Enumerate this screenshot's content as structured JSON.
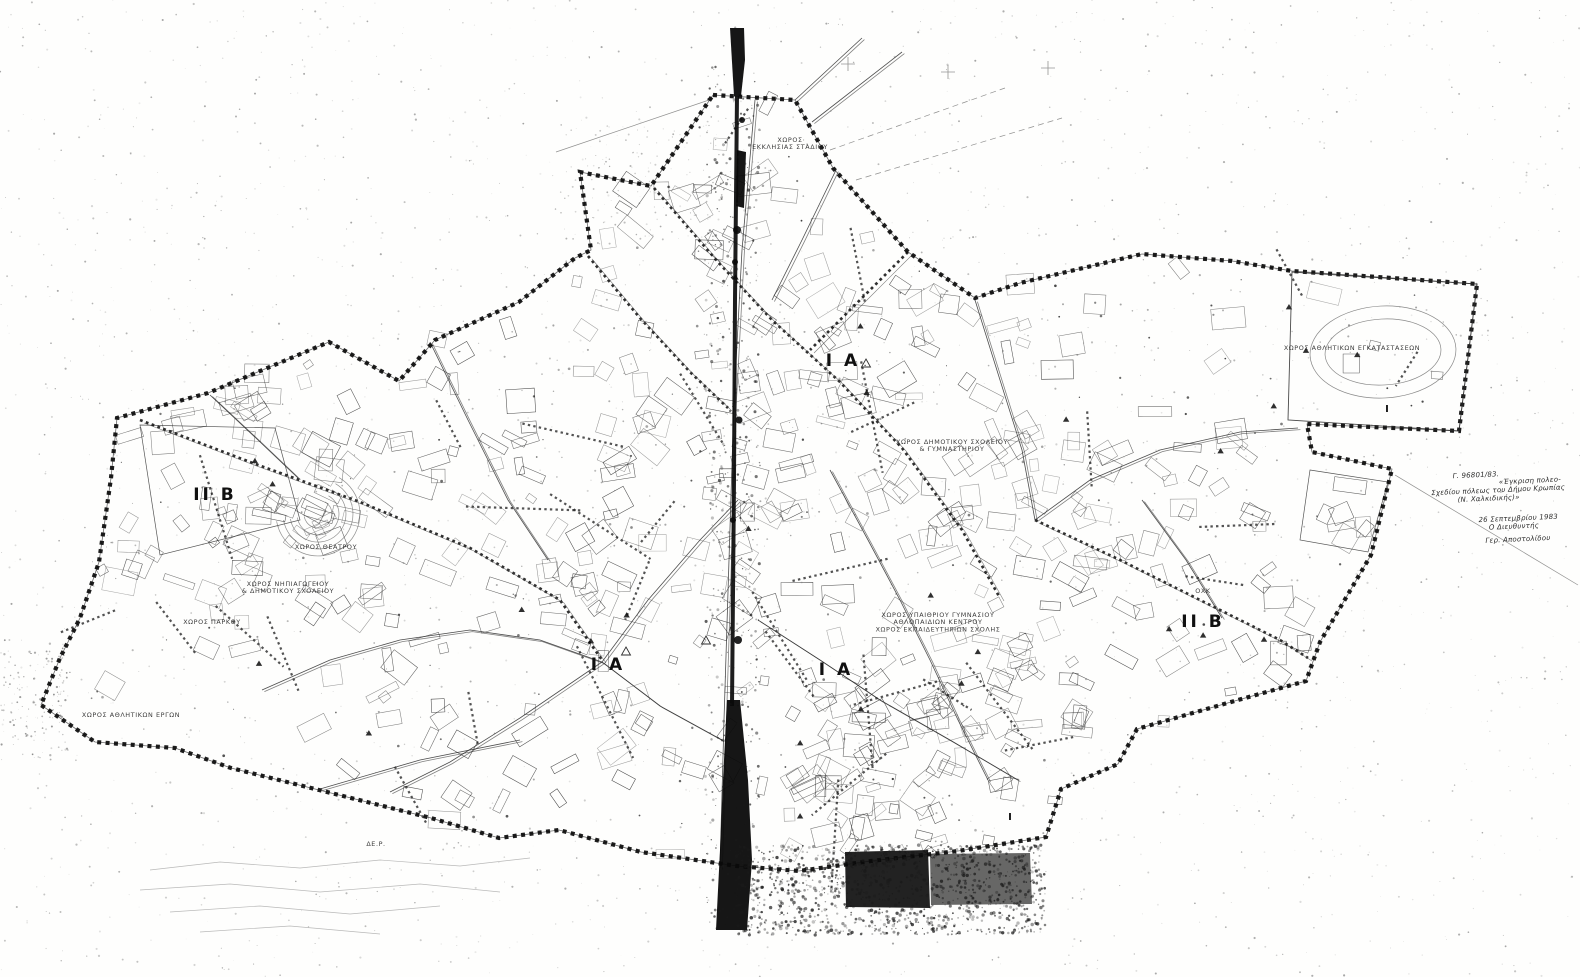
{
  "document": {
    "kind": "scanned black-and-white town plan (two sheets joined, dark fold seam in middle)",
    "ink_color": "#0a0a0a",
    "paper_color": "#fefefd"
  },
  "annotation": {
    "lines": [
      "Γ. 96801/83.",
      "«Έγκριση πολεο-",
      "Σχεδίου πόλεως του Δήμου Κρωπίας",
      "(Ν. Χαλκιδικής)»",
      "26 Σεπτεμβρίου 1983",
      "Ο Διευθυντής",
      "Γερ. Αποστολίδου"
    ]
  },
  "map": {
    "boundary": [
      [
        713,
        95
      ],
      [
        795,
        100
      ],
      [
        833,
        168
      ],
      [
        908,
        252
      ],
      [
        975,
        298
      ],
      [
        1020,
        283
      ],
      [
        1142,
        254
      ],
      [
        1232,
        261
      ],
      [
        1292,
        271
      ],
      [
        1477,
        284
      ],
      [
        1459,
        431
      ],
      [
        1307,
        424
      ],
      [
        1312,
        452
      ],
      [
        1392,
        469
      ],
      [
        1371,
        555
      ],
      [
        1320,
        642
      ],
      [
        1306,
        681
      ],
      [
        1238,
        700
      ],
      [
        1137,
        729
      ],
      [
        1118,
        764
      ],
      [
        1061,
        789
      ],
      [
        1046,
        837
      ],
      [
        958,
        851
      ],
      [
        871,
        861
      ],
      [
        799,
        871
      ],
      [
        737,
        866
      ],
      [
        641,
        852
      ],
      [
        559,
        830
      ],
      [
        499,
        838
      ],
      [
        431,
        818
      ],
      [
        319,
        790
      ],
      [
        231,
        768
      ],
      [
        175,
        748
      ],
      [
        95,
        742
      ],
      [
        41,
        705
      ],
      [
        60,
        658
      ],
      [
        80,
        618
      ],
      [
        99,
        562
      ],
      [
        111,
        478
      ],
      [
        117,
        418
      ],
      [
        208,
        393
      ],
      [
        329,
        342
      ],
      [
        399,
        381
      ],
      [
        435,
        340
      ],
      [
        519,
        302
      ],
      [
        575,
        258
      ],
      [
        591,
        250
      ],
      [
        580,
        172
      ],
      [
        651,
        186
      ]
    ],
    "roads": [
      {
        "style": "thin",
        "pts": [
          [
            755,
            100
          ],
          [
            742,
            250
          ],
          [
            734,
            400
          ],
          [
            729,
            560
          ],
          [
            724,
            720
          ],
          [
            720,
            868
          ]
        ]
      },
      {
        "style": "dotted",
        "pts": [
          [
            654,
            188
          ],
          [
            718,
            262
          ],
          [
            772,
            320
          ],
          [
            840,
            382
          ],
          [
            902,
            448
          ],
          [
            962,
            530
          ],
          [
            1000,
            598
          ]
        ]
      },
      {
        "style": "dotted",
        "pts": [
          [
            588,
            256
          ],
          [
            640,
            318
          ],
          [
            690,
            372
          ],
          [
            728,
            408
          ]
        ]
      },
      {
        "style": "dotted",
        "pts": [
          [
            140,
            420
          ],
          [
            250,
            462
          ],
          [
            360,
            502
          ],
          [
            470,
            548
          ],
          [
            560,
            600
          ],
          [
            602,
            660
          ]
        ]
      },
      {
        "style": "thin",
        "pts": [
          [
            602,
            662
          ],
          [
            520,
            718
          ],
          [
            450,
            762
          ],
          [
            390,
            792
          ]
        ]
      },
      {
        "style": "thin",
        "pts": [
          [
            602,
            662
          ],
          [
            660,
            706
          ],
          [
            722,
            740
          ]
        ]
      },
      {
        "style": "thin",
        "pts": [
          [
            602,
            662
          ],
          [
            648,
            600
          ],
          [
            700,
            540
          ],
          [
            738,
            500
          ]
        ]
      },
      {
        "style": "thin",
        "pts": [
          [
            602,
            662
          ],
          [
            540,
            640
          ],
          [
            470,
            630
          ],
          [
            400,
            640
          ],
          [
            330,
            660
          ],
          [
            262,
            690
          ]
        ]
      },
      {
        "style": "thin",
        "pts": [
          [
            975,
            300
          ],
          [
            1000,
            380
          ],
          [
            1022,
            450
          ],
          [
            1035,
            520
          ]
        ]
      },
      {
        "style": "dotted",
        "pts": [
          [
            1035,
            520
          ],
          [
            1120,
            560
          ],
          [
            1200,
            600
          ],
          [
            1280,
            640
          ],
          [
            1308,
            658
          ]
        ]
      },
      {
        "style": "thin",
        "pts": [
          [
            1035,
            520
          ],
          [
            1090,
            480
          ],
          [
            1160,
            450
          ],
          [
            1240,
            432
          ],
          [
            1298,
            428
          ]
        ]
      },
      {
        "style": "thin",
        "pts": [
          [
            830,
            470
          ],
          [
            868,
            540
          ],
          [
            900,
            600
          ],
          [
            930,
            660
          ],
          [
            958,
            720
          ],
          [
            988,
            780
          ]
        ]
      },
      {
        "style": "thin",
        "pts": [
          [
            758,
            620
          ],
          [
            820,
            660
          ],
          [
            880,
            700
          ],
          [
            950,
            740
          ],
          [
            1018,
            780
          ]
        ]
      },
      {
        "style": "thin",
        "pts": [
          [
            430,
            342
          ],
          [
            468,
            420
          ],
          [
            508,
            500
          ],
          [
            548,
            560
          ]
        ]
      },
      {
        "style": "thin",
        "pts": [
          [
            210,
            395
          ],
          [
            258,
            440
          ],
          [
            298,
            478
          ]
        ]
      },
      {
        "style": "thin",
        "pts": [
          [
            320,
            789
          ],
          [
            420,
            760
          ],
          [
            520,
            740
          ]
        ]
      },
      {
        "style": "thin",
        "pts": [
          [
            836,
            170
          ],
          [
            802,
            240
          ],
          [
            772,
            300
          ]
        ]
      },
      {
        "style": "thin",
        "pts": [
          [
            795,
            100
          ],
          [
            862,
            38
          ]
        ]
      },
      {
        "style": "thin",
        "pts": [
          [
            812,
            122
          ],
          [
            902,
            52
          ]
        ]
      },
      {
        "style": "dotted",
        "pts": [
          [
            908,
            252
          ],
          [
            860,
            300
          ],
          [
            810,
            350
          ]
        ]
      },
      {
        "style": "thin",
        "pts": [
          [
            1142,
            500
          ],
          [
            1186,
            560
          ],
          [
            1222,
            618
          ]
        ]
      }
    ],
    "construction_lines": [
      {
        "pts": [
          [
            830,
            150
          ],
          [
            1005,
            88
          ]
        ],
        "dashed": true
      },
      {
        "pts": [
          [
            856,
            180
          ],
          [
            1062,
            118
          ]
        ],
        "dashed": true
      },
      {
        "pts": [
          [
            1395,
            475
          ],
          [
            1578,
            585
          ]
        ],
        "dashed": false
      },
      {
        "pts": [
          [
            556,
            152
          ],
          [
            712,
            99
          ]
        ],
        "dashed": false
      }
    ],
    "seam": {
      "bars": [
        [
          [
            730,
            28
          ],
          [
            744,
            28
          ],
          [
            745,
            60
          ],
          [
            741,
            96
          ],
          [
            734,
            96
          ]
        ],
        [
          [
            737,
            150
          ],
          [
            746,
            152
          ],
          [
            744,
            208
          ],
          [
            736,
            206
          ]
        ],
        [
          [
            727,
            700
          ],
          [
            740,
            700
          ],
          [
            748,
            780
          ],
          [
            752,
            860
          ],
          [
            747,
            930
          ],
          [
            716,
            930
          ],
          [
            720,
            850
          ],
          [
            723,
            780
          ]
        ]
      ],
      "line_pts": [
        [
          737,
          96
        ],
        [
          735,
          300
        ],
        [
          734,
          480
        ],
        [
          732,
          706
        ]
      ],
      "blobs": [
        [
          737,
          230,
          4
        ],
        [
          735,
          262,
          3
        ],
        [
          739,
          420,
          3.5
        ],
        [
          733,
          520,
          3
        ],
        [
          738,
          640,
          4
        ],
        [
          742,
          120,
          3
        ]
      ],
      "rects": [
        {
          "poly": [
            [
              845,
              852
            ],
            [
              928,
              850
            ],
            [
              930,
              908
            ],
            [
              846,
              907
            ]
          ],
          "opacity": 0.9
        },
        {
          "poly": [
            [
              930,
              854
            ],
            [
              1030,
              853
            ],
            [
              1032,
              904
            ],
            [
              931,
              905
            ]
          ],
          "opacity": 0.62
        }
      ]
    },
    "features": {
      "stadium_poly": [
        [
          1292,
          272
        ],
        [
          1477,
          284
        ],
        [
          1459,
          431
        ],
        [
          1288,
          420
        ]
      ],
      "ellipses": [
        {
          "cx": 1383,
          "cy": 352,
          "rx": 73,
          "ry": 46,
          "rot": -3
        },
        {
          "cx": 1383,
          "cy": 352,
          "rx": 58,
          "ry": 33,
          "rot": -3
        }
      ],
      "amphitheater": {
        "cx": 318,
        "cy": 514,
        "radii": [
          14,
          21,
          28,
          35,
          42
        ],
        "a0": -60,
        "a1": 170
      },
      "plus_marks": [
        [
          848,
          64
        ],
        [
          948,
          72
        ],
        [
          1048,
          68
        ]
      ],
      "open_triangles": [
        [
          626,
          652
        ],
        [
          866,
          364
        ],
        [
          706,
          641
        ]
      ],
      "contours": [
        [
          [
            150,
            870
          ],
          [
            220,
            862
          ],
          [
            300,
            868
          ],
          [
            380,
            860
          ],
          [
            460,
            866
          ],
          [
            530,
            858
          ]
        ],
        [
          [
            140,
            890
          ],
          [
            230,
            884
          ],
          [
            320,
            892
          ],
          [
            420,
            884
          ],
          [
            500,
            892
          ]
        ],
        [
          [
            170,
            912
          ],
          [
            260,
            906
          ],
          [
            350,
            914
          ],
          [
            440,
            906
          ]
        ],
        [
          [
            200,
            932
          ],
          [
            290,
            926
          ],
          [
            380,
            934
          ]
        ]
      ],
      "manual_parcels": [
        [
          [
            140,
            425
          ],
          [
            275,
            428
          ],
          [
            300,
            520
          ],
          [
            160,
            555
          ]
        ],
        [
          [
            1310,
            470
          ],
          [
            1388,
            482
          ],
          [
            1368,
            552
          ],
          [
            1300,
            540
          ]
        ]
      ]
    },
    "labels": {
      "zones": [
        {
          "text": "ΙΙ Β",
          "x": 215,
          "y": 500
        },
        {
          "text": "Ι Α",
          "x": 843,
          "y": 366
        },
        {
          "text": "Ι Α",
          "x": 608,
          "y": 670
        },
        {
          "text": "Ι Α",
          "x": 836,
          "y": 675
        },
        {
          "text": "ΙΙ Β",
          "x": 1203,
          "y": 627
        }
      ],
      "sites": [
        {
          "lines": [
            "ΧΩΡΟΣ",
            "ΕΚΚΛΗΣΙΑΣ ΣΤΑΔΙΟΥ"
          ],
          "x": 790,
          "y": 142
        },
        {
          "lines": [
            "ΧΩΡΟΣ ΝΗΠΙΑΓΩΓΕΙΟΥ",
            "& ΔΗΜΟΤΙΚΟΥ ΣΧΟΛΕΙΟΥ"
          ],
          "x": 288,
          "y": 586
        },
        {
          "lines": [
            "ΧΩΡΟΣ ΠΑΡΚΟΥ"
          ],
          "x": 212,
          "y": 624
        },
        {
          "lines": [
            "ΧΩΡΟΣ ΑΘΛΗΤΙΚΩΝ ΕΡΓΩΝ"
          ],
          "x": 131,
          "y": 717
        },
        {
          "lines": [
            "ΧΩΡΟΣ ΔΗΜΟΤΙΚΟΥ ΣΧΟΛΕΙΟΥ",
            "& ΓΥΜΝΑΣΤΗΡΙΟΥ"
          ],
          "x": 952,
          "y": 444
        },
        {
          "lines": [
            "ΧΩΡΟΣ ΥΠΑΙΘΡΙΟΥ ΓΥΜΝΑΣΙΟΥ",
            "ΑΘΛΟΠΑΙΔΙΩΝ ΚΕΝΤΡΟΥ",
            "ΧΩΡΟΣ ΕΚΠΑΙΔΕΥΤΗΡΙΩΝ ΣΧΟΛΗΣ"
          ],
          "x": 938,
          "y": 617
        },
        {
          "lines": [
            "ΧΩΡΟΣ ΑΘΛΗΤΙΚΩΝ ΕΓΚΑΤΑΣΤΑΣΕΩΝ"
          ],
          "x": 1352,
          "y": 350
        },
        {
          "lines": [
            "ΧΩΡΟΣ ΘΕΑΤΡΟΥ"
          ],
          "x": 326,
          "y": 549
        },
        {
          "lines": [
            "ΔΕ.Ρ."
          ],
          "x": 376,
          "y": 846
        },
        {
          "lines": [
            "ΟΧΚ"
          ],
          "x": 1203,
          "y": 593
        }
      ],
      "minor": [
        {
          "text": "Ι",
          "x": 1387,
          "y": 412
        },
        {
          "text": "Ι",
          "x": 1010,
          "y": 820
        }
      ]
    },
    "decor": {
      "seed": 73,
      "parcel_count": 560,
      "clusters": [
        [
          580,
          630,
          260
        ],
        [
          850,
          640,
          240
        ],
        [
          420,
          520,
          210
        ],
        [
          1150,
          580,
          220
        ],
        [
          760,
          300,
          190
        ],
        [
          900,
          380,
          200
        ],
        [
          220,
          480,
          150
        ],
        [
          950,
          760,
          140
        ]
      ],
      "dotted_segment_count": 34,
      "triangle_count": 26,
      "tick_count": 300
    }
  },
  "noise": {
    "regions": [
      {
        "x": 0,
        "y": 0,
        "w": 1580,
        "h": 977,
        "count": 2600,
        "rmin": 0.3,
        "rmax": 1.1,
        "omin": 0.08,
        "omax": 0.4
      },
      {
        "x": 705,
        "y": 60,
        "w": 55,
        "h": 870,
        "count": 500,
        "rmin": 0.4,
        "rmax": 1.6,
        "omin": 0.2,
        "omax": 0.7
      },
      {
        "x": 735,
        "y": 845,
        "w": 310,
        "h": 90,
        "count": 1200,
        "rmin": 0.5,
        "rmax": 1.8,
        "omin": 0.25,
        "omax": 0.8
      },
      {
        "x": 0,
        "y": 640,
        "w": 70,
        "h": 120,
        "count": 150,
        "rmin": 0.3,
        "rmax": 1.2,
        "omin": 0.15,
        "omax": 0.5
      },
      {
        "x": 560,
        "y": 120,
        "w": 160,
        "h": 120,
        "count": 120,
        "rmin": 0.3,
        "rmax": 1.0,
        "omin": 0.1,
        "omax": 0.35
      }
    ]
  }
}
